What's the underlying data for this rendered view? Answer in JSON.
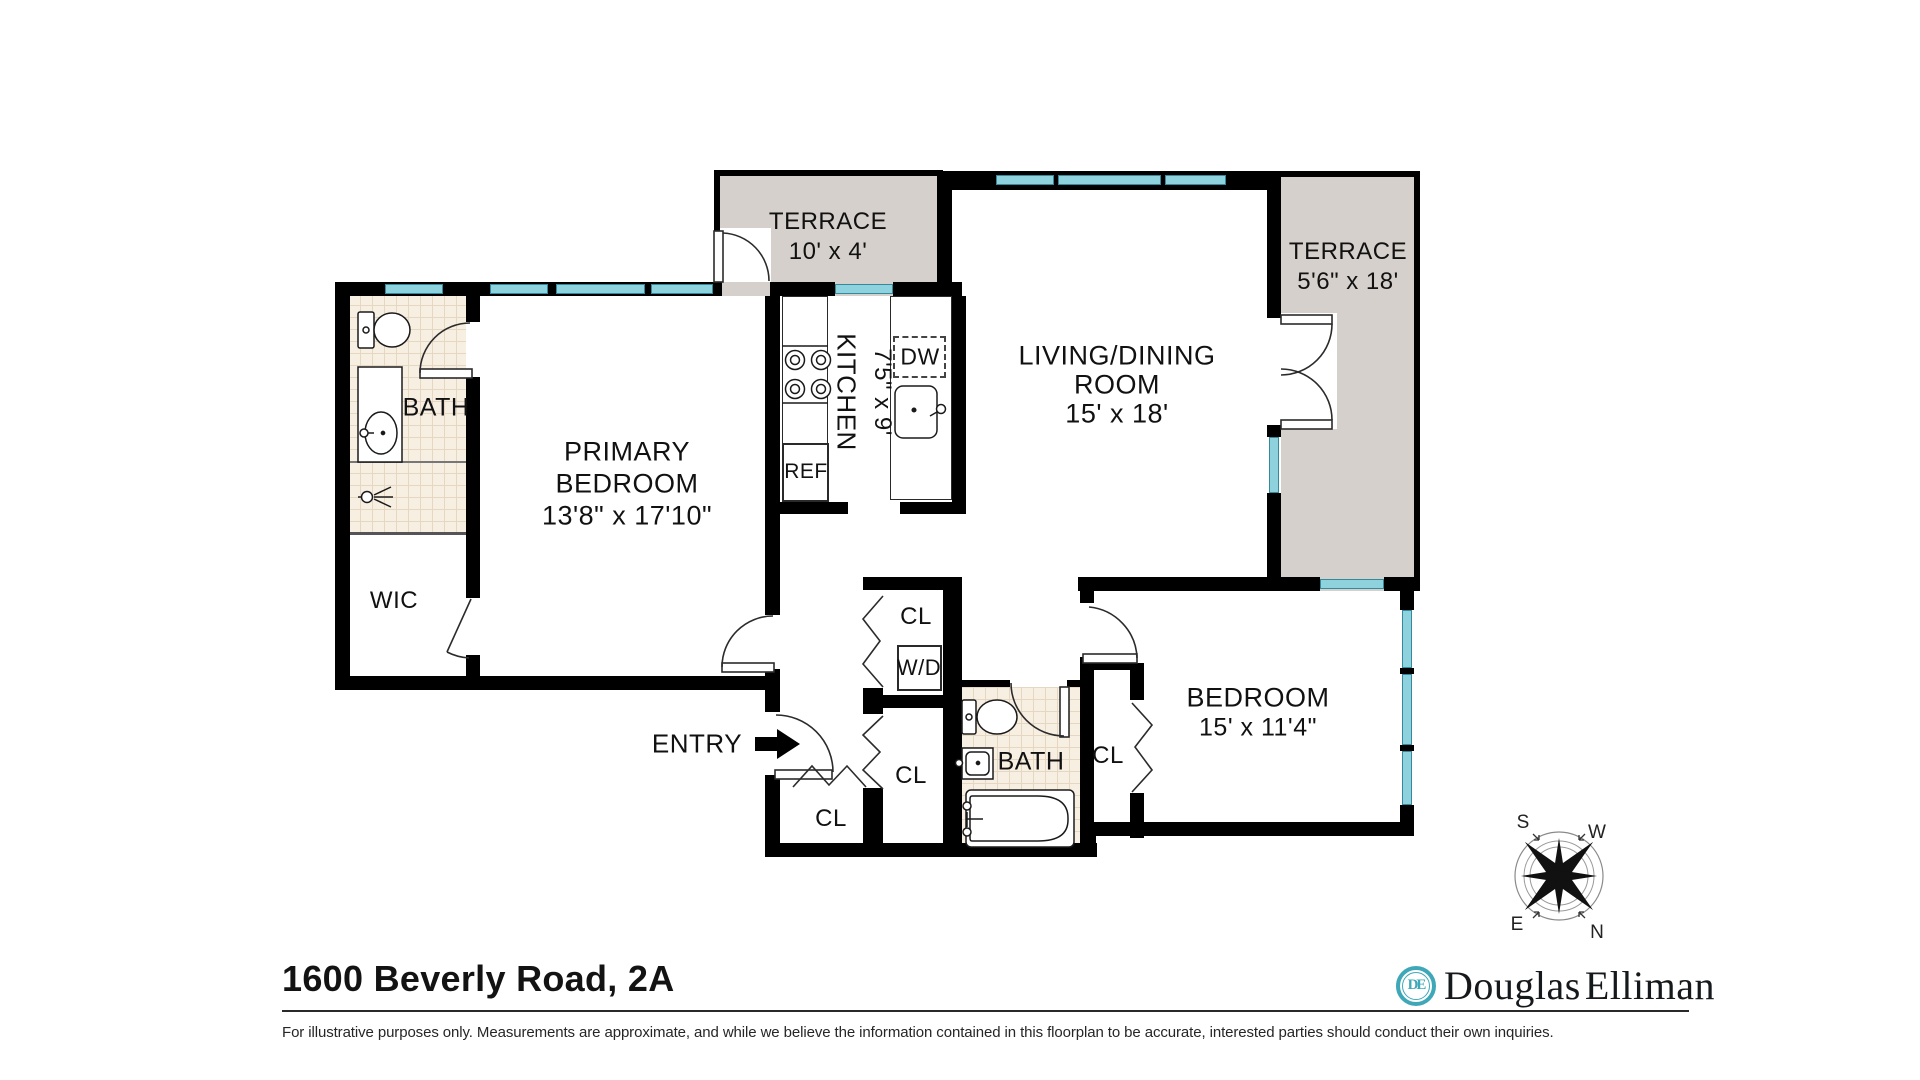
{
  "title": "1600 Beverly Road, 2A",
  "disclaimer": "For illustrative purposes only.  Measurements are approximate, and while we believe the information contained in this floorplan to be accurate, interested parties should conduct their own inquiries.",
  "brand": {
    "monogram": "DE",
    "name_left": "Douglas",
    "name_right": "Elliman"
  },
  "compass": {
    "n": "N",
    "s": "S",
    "e": "E",
    "w": "W"
  },
  "colors": {
    "wall": "#000000",
    "terrace_fill": "#d5d0cb",
    "window_teal": "#8ed2de",
    "tile": "#f8efe3",
    "brand_teal": "#3fa8b8"
  },
  "rooms": {
    "terrace_left": {
      "label": "TERRACE",
      "dims": "10' x 4'"
    },
    "terrace_right": {
      "label": "TERRACE",
      "dims": "5'6\" x 18'"
    },
    "living": {
      "label1": "LIVING/DINING",
      "label2": "ROOM",
      "dims": "15' x 18'"
    },
    "primary": {
      "label1": "PRIMARY",
      "label2": "BEDROOM",
      "dims": "13'8\" x 17'10\""
    },
    "kitchen": {
      "label": "KITCHEN",
      "dims": "7'5\" x 9'"
    },
    "bedroom": {
      "label": "BEDROOM",
      "dims": "15' x 11'4\""
    },
    "bath_primary": {
      "label": "BATH"
    },
    "bath_hall": {
      "label": "BATH"
    },
    "wic": {
      "label": "WIC"
    },
    "entry": {
      "label": "ENTRY"
    },
    "cl_top": {
      "label": "CL"
    },
    "cl_mid": {
      "label": "CL"
    },
    "cl_bottom": {
      "label": "CL"
    },
    "cl_bedroom": {
      "label": "CL"
    },
    "wd": {
      "label": "W/D"
    },
    "ref": {
      "label": "REF"
    },
    "dw": {
      "label": "DW"
    }
  }
}
